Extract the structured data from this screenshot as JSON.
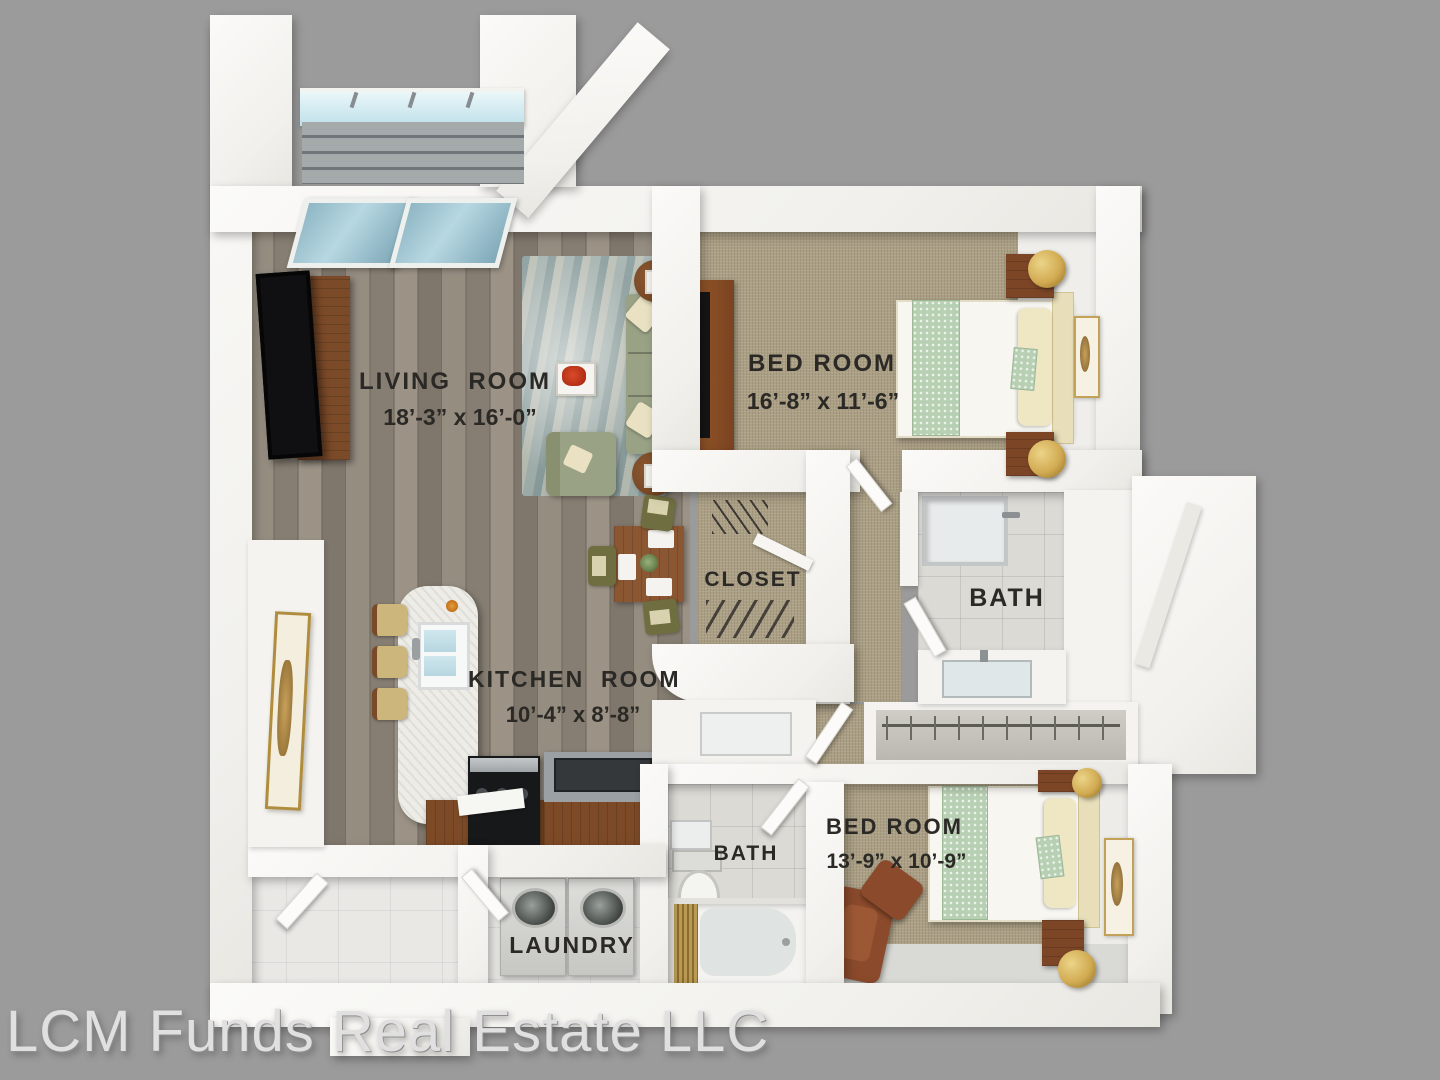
{
  "scene": {
    "background_color": "#9b9b9b",
    "watermark": "LCM Funds Real Estate LLC"
  },
  "rooms": {
    "living_room": {
      "label": "LIVING  ROOM",
      "dimensions": "18’-3” x 16’-0”"
    },
    "bedroom_top": {
      "label": "BED ROOM",
      "dimensions": "16’-8” x 11’-6”"
    },
    "kitchen": {
      "label": "KITCHEN  ROOM",
      "dimensions": "10’-4” x 8’-8”"
    },
    "closet": {
      "label": "CLOSET"
    },
    "bath_top": {
      "label": "BATH"
    },
    "bath_bottom": {
      "label": "BATH"
    },
    "bedroom_bottom": {
      "label": "BED ROOM",
      "dimensions": "13’-9” x 10’-9”"
    },
    "laundry": {
      "label": "LAUNDRY"
    }
  },
  "colors": {
    "wall": "#f7f6f3",
    "wood_floor": "#8c8478",
    "carpet": "#ab9f84",
    "tile": "#dbdad5",
    "sofa_green": "#9aa286",
    "cabinet_brown": "#7c4a26",
    "marble": "#edece7",
    "glass_blue": "#a8cdd9",
    "lamp_gold": "#cda84e",
    "leather_brown": "#8a4a2b",
    "label_text": "#2b2925",
    "watermark_text": "#e0e0e0"
  }
}
